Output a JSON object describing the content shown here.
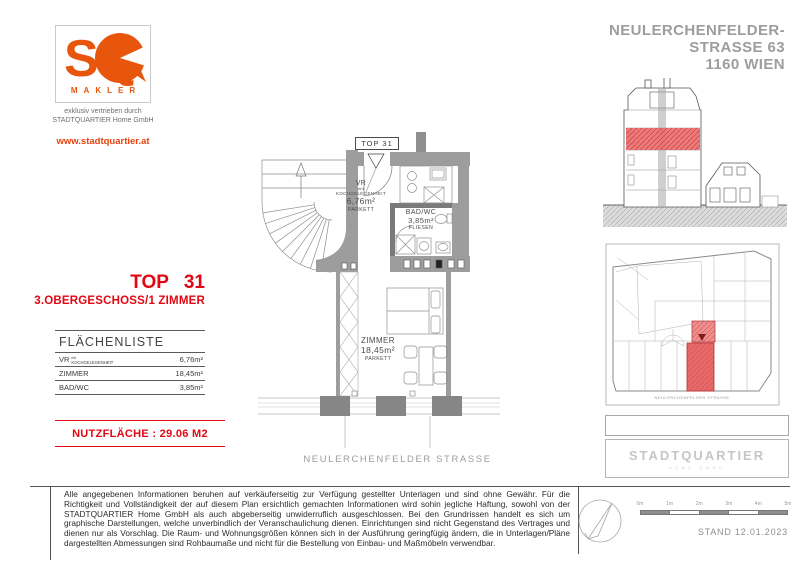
{
  "colors": {
    "accent_orange": "#E8560D",
    "brand_red": "#E30613",
    "title_gray": "#9D9D9C",
    "plan_highlight_red": "#E86A6A",
    "wall_gray": "#9D9D9D"
  },
  "branding": {
    "logo": "SQ",
    "logo_sub": "MAKLER",
    "distributed_by_line1": "exklusiv vertrieben durch",
    "distributed_by_line2": "STADTQUARTIER Home GmbH",
    "website": "www.stadtquartier.at"
  },
  "header": {
    "title_line1": "NEULERCHENFELDER-",
    "title_line2": "STRASSE 63",
    "title_line3": "1160 WIEN"
  },
  "unit": {
    "top_label": "TOP 31",
    "floor_line": "3.OBERGESCHOSS/1 ZIMMER"
  },
  "area_table": {
    "title": "FLÄCHENLISTE",
    "rows": [
      {
        "label": "VR",
        "note_top": "mit",
        "note": "KOCHGELEGENHEIT",
        "value": "6,76m²"
      },
      {
        "label": "ZIMMER",
        "value": "18,45m²"
      },
      {
        "label": "BAD/WC",
        "value": "3,85m²"
      }
    ]
  },
  "nutzflaeche_label": "NUTZFLÄCHE : 29.06 M2",
  "floorplan": {
    "top_marker": "TOP 31",
    "rooms": {
      "vr": {
        "name": "VR",
        "note_top": "mit",
        "note": "KOCHGELEGENHEIT",
        "area": "6,76m²",
        "floor": "PARKETT"
      },
      "bad": {
        "name": "BAD/WC",
        "area": "3,85m²",
        "floor": "FLIESEN"
      },
      "zimmer": {
        "name": "ZIMMER",
        "area": "18,45m²",
        "floor": "PARKETT"
      }
    },
    "street_label": "NEULERCHENFELDER STRASSE"
  },
  "siteplan": {
    "street_label": "NEULERCHENFELDER STRASSE"
  },
  "logo_box": {
    "title": "STADTQUARTIER",
    "subtitle": "HOME GMBH"
  },
  "footer": {
    "disclaimer": "Alle angegebenen Informationen beruhen auf verkäuferseitig zur Verfügung gestellter Unterlagen und sind ohne Gewähr. Für die Richtigkeit und Vollständigkeit der auf diesem Plan ersichtlich gemachten Informationen wird sohin jegliche Haftung, sowohl von der STADTQUARTIER Home GmbH als auch abgeberseitig unwiderruflich ausgeschlossen. Bei den Grundrissen handelt es sich um graphische Darstellungen, welche unverbindlich der Veranschaulichung dienen. Einrichtungen sind nicht Gegenstand des Vertrages und dienen nur als Vorschlag. Die Raum- und Wohnungsgrößen können sich in der Ausführung geringfügig ändern, die in Unterlagen/Pläne dargestellten Abmessungen sind Rohbaumaße und nicht für die Bestellung von Einbau- und Maßmöbeln verwendbar.",
    "stand": "STAND 12.01.2023",
    "scale_labels": [
      "0m",
      "1m",
      "2m",
      "3m",
      "4m",
      "5m"
    ]
  }
}
